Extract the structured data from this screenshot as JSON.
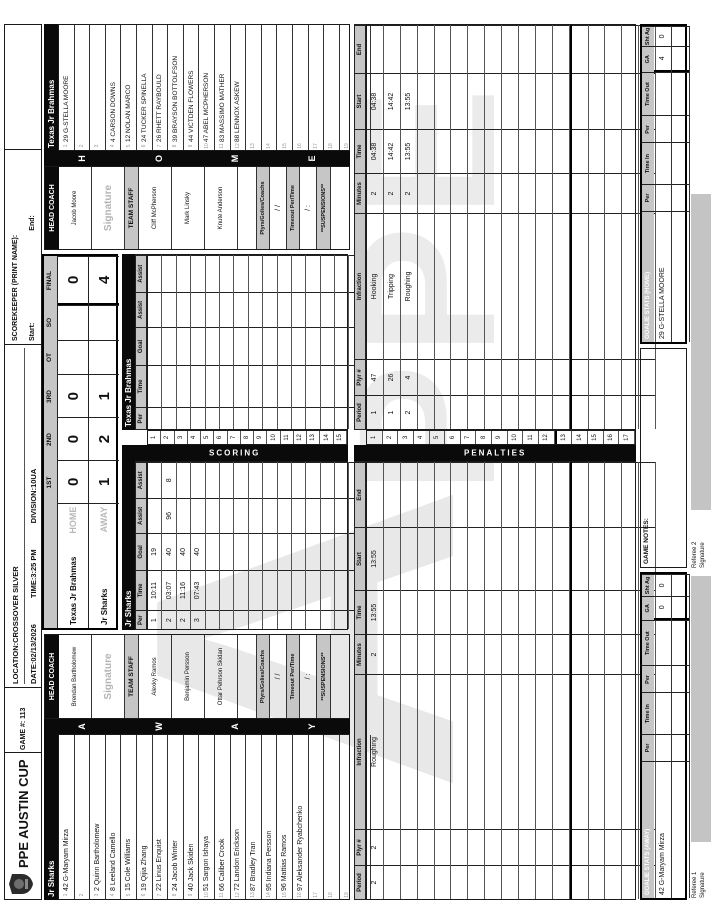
{
  "meta": {
    "title": "PPE AUSTIN CUP",
    "game": "GAME #: 113",
    "location": "LOCATION:CROSSOVER SILVER",
    "date": "DATE:02/13/2026",
    "time": "TIME:3:25 PM",
    "division": "DIVISION:10UA",
    "scorekeeper_label": "SCOREKEEPER (PRINT NAME):",
    "start_label": "Start:",
    "end_label": "End:"
  },
  "colors": {
    "band_black": "#0a0a0a",
    "band_grey": "#c6c6c6",
    "signature_grey": "#c4c4c4",
    "watermark_grey": "#e8e8e8"
  },
  "goals": {
    "header": "GOALS SCORED PER PERIOD",
    "columns": [
      "1ST",
      "2ND",
      "3RD",
      "OT",
      "SO",
      "FINAL"
    ],
    "rows": [
      {
        "team": "Texas Jr Brahmas",
        "side": "HOME",
        "values": [
          "0",
          "0",
          "0",
          "",
          "",
          "0"
        ]
      },
      {
        "team": "Jr Sharks",
        "side": "AWAY",
        "values": [
          "1",
          "2",
          "1",
          "",
          "",
          "4"
        ]
      }
    ]
  },
  "away": {
    "name": "Jr Sharks",
    "side_label": "AWAY",
    "side_letters": [
      {
        "ch": "A"
      },
      {
        "ch": "W"
      },
      {
        "ch": "A"
      },
      {
        "ch": "Y"
      }
    ],
    "head_coach_label": "HEAD COACH",
    "head_coach": "Brendan Bartholomew",
    "signature_label": "Signature",
    "team_staff_label": "TEAM STAFF",
    "staff1": "Alexky Ramos",
    "staff2": "Benjamin Persson",
    "staff3": "Ottar Pehrson Skidan",
    "plyrs_label": "Plyrs/Golies/Coachs",
    "plyrs_value": "/      /",
    "timeout_label": "Timeout Per/Time",
    "timeout_value": "/      :",
    "suspensions_label": "**SUSPENSIONS**",
    "roster": [
      {
        "idx": "1",
        "entry": "42 G-Maryam Mirza"
      },
      {
        "idx": "2",
        "entry": ""
      },
      {
        "idx": "3",
        "entry": "2  Quinn Bartholomew"
      },
      {
        "idx": "4",
        "entry": "8  Leeland Camello"
      },
      {
        "idx": "5",
        "entry": "15 Cole Williams"
      },
      {
        "idx": "6",
        "entry": "19 Qijia Zhang"
      },
      {
        "idx": "7",
        "entry": "22 Linus Enquist"
      },
      {
        "idx": "8",
        "entry": "24 Jacob Winter"
      },
      {
        "idx": "9",
        "entry": "40 Jack Skiden"
      },
      {
        "idx": "10",
        "entry": "51 Sargon Ishaya"
      },
      {
        "idx": "11",
        "entry": "66 Caliber Crook"
      },
      {
        "idx": "12",
        "entry": "72 Landon Erickson"
      },
      {
        "idx": "13",
        "entry": "87 Bradley Tran"
      },
      {
        "idx": "14",
        "entry": "95 Indiana Persson"
      },
      {
        "idx": "15",
        "entry": "96 Mattias Ramos"
      },
      {
        "idx": "16",
        "entry": "97 Aleksander Ryabchenko"
      },
      {
        "idx": "17",
        "entry": ""
      },
      {
        "idx": "18",
        "entry": ""
      },
      {
        "idx": "19",
        "entry": ""
      },
      {
        "idx": "20",
        "entry": ""
      }
    ]
  },
  "home": {
    "name": "Texas Jr Brahmas",
    "side_label": "HOME",
    "side_letters": [
      {
        "ch": "H"
      },
      {
        "ch": "O"
      },
      {
        "ch": "M"
      },
      {
        "ch": "E"
      }
    ],
    "head_coach_label": "HEAD COACH",
    "head_coach": "Jacob Moore",
    "signature_label": "Signature",
    "team_staff_label": "TEAM STAFF",
    "staff1": "Cliff McPherson",
    "staff2": "Mark Linsky",
    "staff3": "Knute Anderson",
    "plyrs_label": "Plyrs/Golies/Coachs",
    "plyrs_value": "/      /",
    "timeout_label": "Timeout Per/Time",
    "timeout_value": "/      :",
    "suspensions_label": "**SUSPENSIONS**",
    "roster": [
      {
        "idx": "1",
        "entry": "29 G-STELLA MOORE"
      },
      {
        "idx": "2",
        "entry": ""
      },
      {
        "idx": "3",
        "entry": ""
      },
      {
        "idx": "4",
        "entry": "4  CARSON DOWNS"
      },
      {
        "idx": "5",
        "entry": "12 NOLAN MARCO"
      },
      {
        "idx": "6",
        "entry": "24 TUCKER SPINELLA"
      },
      {
        "idx": "7",
        "entry": "26 RHETT RAYBOULD"
      },
      {
        "idx": "8",
        "entry": "39 BRAYSON BOTTOLFSON"
      },
      {
        "idx": "9",
        "entry": "44 VICTDEN FLOWERS"
      },
      {
        "idx": "10",
        "entry": "47 ABEL MCPHERSON"
      },
      {
        "idx": "11",
        "entry": "83 MASSIMO MATHER"
      },
      {
        "idx": "12",
        "entry": "88 LENNOX ASKEW"
      },
      {
        "idx": "13",
        "entry": ""
      },
      {
        "idx": "14",
        "entry": ""
      },
      {
        "idx": "15",
        "entry": ""
      },
      {
        "idx": "16",
        "entry": ""
      },
      {
        "idx": "17",
        "entry": ""
      },
      {
        "idx": "18",
        "entry": ""
      },
      {
        "idx": "19",
        "entry": ""
      },
      {
        "idx": "20",
        "entry": ""
      }
    ]
  },
  "scoring": {
    "section_label": "SCORING",
    "columns": [
      "Per",
      "Time",
      "Goal",
      "Assist",
      "Assist"
    ],
    "row_numbers": [
      {
        "n": "1"
      },
      {
        "n": "2"
      },
      {
        "n": "3"
      },
      {
        "n": "4"
      },
      {
        "n": "5"
      },
      {
        "n": "6"
      },
      {
        "n": "7"
      },
      {
        "n": "8"
      },
      {
        "n": "9"
      },
      {
        "n": "10"
      },
      {
        "n": "11"
      },
      {
        "n": "12"
      },
      {
        "n": "13"
      },
      {
        "n": "14"
      },
      {
        "n": "15"
      }
    ],
    "away_rows": [
      {
        "per": "1",
        "time": "10:11",
        "goal": "19",
        "a1": "",
        "a2": ""
      },
      {
        "per": "2",
        "time": "03:07",
        "goal": "40",
        "a1": "96",
        "a2": "8"
      },
      {
        "per": "2",
        "time": "11:16",
        "goal": "40",
        "a1": "",
        "a2": ""
      },
      {
        "per": "3",
        "time": "07:43",
        "goal": "40",
        "a1": "",
        "a2": ""
      },
      {
        "per": "",
        "time": "",
        "goal": "",
        "a1": "",
        "a2": ""
      },
      {
        "per": "",
        "time": "",
        "goal": "",
        "a1": "",
        "a2": ""
      },
      {
        "per": "",
        "time": "",
        "goal": "",
        "a1": "",
        "a2": ""
      },
      {
        "per": "",
        "time": "",
        "goal": "",
        "a1": "",
        "a2": ""
      },
      {
        "per": "",
        "time": "",
        "goal": "",
        "a1": "",
        "a2": ""
      },
      {
        "per": "",
        "time": "",
        "goal": "",
        "a1": "",
        "a2": ""
      },
      {
        "per": "",
        "time": "",
        "goal": "",
        "a1": "",
        "a2": ""
      },
      {
        "per": "",
        "time": "",
        "goal": "",
        "a1": "",
        "a2": ""
      },
      {
        "per": "",
        "time": "",
        "goal": "",
        "a1": "",
        "a2": ""
      },
      {
        "per": "",
        "time": "",
        "goal": "",
        "a1": "",
        "a2": ""
      },
      {
        "per": "",
        "time": "",
        "goal": "",
        "a1": "",
        "a2": ""
      }
    ],
    "home_rows": [
      {
        "per": "",
        "time": "",
        "goal": "",
        "a1": "",
        "a2": ""
      },
      {
        "per": "",
        "time": "",
        "goal": "",
        "a1": "",
        "a2": ""
      },
      {
        "per": "",
        "time": "",
        "goal": "",
        "a1": "",
        "a2": ""
      },
      {
        "per": "",
        "time": "",
        "goal": "",
        "a1": "",
        "a2": ""
      },
      {
        "per": "",
        "time": "",
        "goal": "",
        "a1": "",
        "a2": ""
      },
      {
        "per": "",
        "time": "",
        "goal": "",
        "a1": "",
        "a2": ""
      },
      {
        "per": "",
        "time": "",
        "goal": "",
        "a1": "",
        "a2": ""
      },
      {
        "per": "",
        "time": "",
        "goal": "",
        "a1": "",
        "a2": ""
      },
      {
        "per": "",
        "time": "",
        "goal": "",
        "a1": "",
        "a2": ""
      },
      {
        "per": "",
        "time": "",
        "goal": "",
        "a1": "",
        "a2": ""
      },
      {
        "per": "",
        "time": "",
        "goal": "",
        "a1": "",
        "a2": ""
      },
      {
        "per": "",
        "time": "",
        "goal": "",
        "a1": "",
        "a2": ""
      },
      {
        "per": "",
        "time": "",
        "goal": "",
        "a1": "",
        "a2": ""
      },
      {
        "per": "",
        "time": "",
        "goal": "",
        "a1": "",
        "a2": ""
      },
      {
        "per": "",
        "time": "",
        "goal": "",
        "a1": "",
        "a2": ""
      }
    ]
  },
  "penalties": {
    "section_label": "PENALTIES",
    "columns": [
      "Period",
      "Plyr #",
      "Infraction",
      "Minutes",
      "Time",
      "Start",
      "End"
    ],
    "row_numbers": [
      {
        "n": "1"
      },
      {
        "n": "2"
      },
      {
        "n": "3"
      },
      {
        "n": "4"
      },
      {
        "n": "5"
      },
      {
        "n": "6"
      },
      {
        "n": "7"
      },
      {
        "n": "8"
      },
      {
        "n": "9"
      },
      {
        "n": "10"
      },
      {
        "n": "11"
      },
      {
        "n": "12"
      },
      {
        "n": "13"
      },
      {
        "n": "14"
      },
      {
        "n": "15"
      },
      {
        "n": "16"
      },
      {
        "n": "17"
      }
    ],
    "away_rows": [
      {
        "p": "2",
        "pl": "2",
        "inf": "Roughing",
        "min": "2",
        "t": "13:55",
        "s": "13:55",
        "e": ""
      },
      {
        "p": "",
        "pl": "",
        "inf": "",
        "min": "",
        "t": "",
        "s": "",
        "e": ""
      },
      {
        "p": "",
        "pl": "",
        "inf": "",
        "min": "",
        "t": "",
        "s": "",
        "e": ""
      },
      {
        "p": "",
        "pl": "",
        "inf": "",
        "min": "",
        "t": "",
        "s": "",
        "e": ""
      },
      {
        "p": "",
        "pl": "",
        "inf": "",
        "min": "",
        "t": "",
        "s": "",
        "e": ""
      },
      {
        "p": "",
        "pl": "",
        "inf": "",
        "min": "",
        "t": "",
        "s": "",
        "e": ""
      },
      {
        "p": "",
        "pl": "",
        "inf": "",
        "min": "",
        "t": "",
        "s": "",
        "e": ""
      },
      {
        "p": "",
        "pl": "",
        "inf": "",
        "min": "",
        "t": "",
        "s": "",
        "e": ""
      },
      {
        "p": "",
        "pl": "",
        "inf": "",
        "min": "",
        "t": "",
        "s": "",
        "e": ""
      },
      {
        "p": "",
        "pl": "",
        "inf": "",
        "min": "",
        "t": "",
        "s": "",
        "e": ""
      },
      {
        "p": "",
        "pl": "",
        "inf": "",
        "min": "",
        "t": "",
        "s": "",
        "e": ""
      },
      {
        "p": "",
        "pl": "",
        "inf": "",
        "min": "",
        "t": "",
        "s": "",
        "e": ""
      },
      {
        "p": "",
        "pl": "",
        "inf": "",
        "min": "",
        "t": "",
        "s": "",
        "e": ""
      },
      {
        "p": "",
        "pl": "",
        "inf": "",
        "min": "",
        "t": "",
        "s": "",
        "e": ""
      },
      {
        "p": "",
        "pl": "",
        "inf": "",
        "min": "",
        "t": "",
        "s": "",
        "e": ""
      },
      {
        "p": "",
        "pl": "",
        "inf": "",
        "min": "",
        "t": "",
        "s": "",
        "e": ""
      },
      {
        "p": "",
        "pl": "",
        "inf": "",
        "min": "",
        "t": "",
        "s": "",
        "e": ""
      }
    ],
    "home_rows": [
      {
        "p": "1",
        "pl": "47",
        "inf": "Hooking",
        "min": "2",
        "t": "04:38",
        "s": "04:38",
        "e": ""
      },
      {
        "p": "1",
        "pl": "26",
        "inf": "Tripping",
        "min": "2",
        "t": "14:42",
        "s": "14:42",
        "e": ""
      },
      {
        "p": "2",
        "pl": "4",
        "inf": "Roughing",
        "min": "2",
        "t": "13:55",
        "s": "13:55",
        "e": ""
      },
      {
        "p": "",
        "pl": "",
        "inf": "",
        "min": "",
        "t": "",
        "s": "",
        "e": ""
      },
      {
        "p": "",
        "pl": "",
        "inf": "",
        "min": "",
        "t": "",
        "s": "",
        "e": ""
      },
      {
        "p": "",
        "pl": "",
        "inf": "",
        "min": "",
        "t": "",
        "s": "",
        "e": ""
      },
      {
        "p": "",
        "pl": "",
        "inf": "",
        "min": "",
        "t": "",
        "s": "",
        "e": ""
      },
      {
        "p": "",
        "pl": "",
        "inf": "",
        "min": "",
        "t": "",
        "s": "",
        "e": ""
      },
      {
        "p": "",
        "pl": "",
        "inf": "",
        "min": "",
        "t": "",
        "s": "",
        "e": ""
      },
      {
        "p": "",
        "pl": "",
        "inf": "",
        "min": "",
        "t": "",
        "s": "",
        "e": ""
      },
      {
        "p": "",
        "pl": "",
        "inf": "",
        "min": "",
        "t": "",
        "s": "",
        "e": ""
      },
      {
        "p": "",
        "pl": "",
        "inf": "",
        "min": "",
        "t": "",
        "s": "",
        "e": ""
      },
      {
        "p": "",
        "pl": "",
        "inf": "",
        "min": "",
        "t": "",
        "s": "",
        "e": ""
      },
      {
        "p": "",
        "pl": "",
        "inf": "",
        "min": "",
        "t": "",
        "s": "",
        "e": ""
      },
      {
        "p": "",
        "pl": "",
        "inf": "",
        "min": "",
        "t": "",
        "s": "",
        "e": ""
      },
      {
        "p": "",
        "pl": "",
        "inf": "",
        "min": "",
        "t": "",
        "s": "",
        "e": ""
      },
      {
        "p": "",
        "pl": "",
        "inf": "",
        "min": "",
        "t": "",
        "s": "",
        "e": ""
      }
    ]
  },
  "goalies": {
    "away_label": "GOALIE STATS (AWAY)",
    "home_label": "GOALIE STATS (HOME)",
    "columns": [
      "Per",
      "Time In",
      "Per",
      "Time Out",
      "GA",
      "Sht Ag"
    ],
    "away_rows": [
      {
        "name": "42 G-Maryam Mirza",
        "per": "",
        "tin": "",
        "per2": "",
        "tout": "",
        "ga": "0",
        "sa": "0"
      },
      {
        "name": "",
        "per": "",
        "tin": "",
        "per2": "",
        "tout": "",
        "ga": "",
        "sa": ""
      }
    ],
    "home_rows": [
      {
        "name": "29 G-STELLA MOORE",
        "per": "",
        "tin": "",
        "per2": "",
        "tout": "",
        "ga": "4",
        "sa": "0"
      },
      {
        "name": "",
        "per": "",
        "tin": "",
        "per2": "",
        "tout": "",
        "ga": "",
        "sa": ""
      }
    ]
  },
  "notes": {
    "game_notes_label": "GAME NOTES:"
  },
  "footer": {
    "referee1_label": "Referee 1",
    "referee2_label": "Referee 2",
    "signature_label": "Signature"
  },
  "watermark": {
    "letter": "A",
    "text": "PPE"
  }
}
